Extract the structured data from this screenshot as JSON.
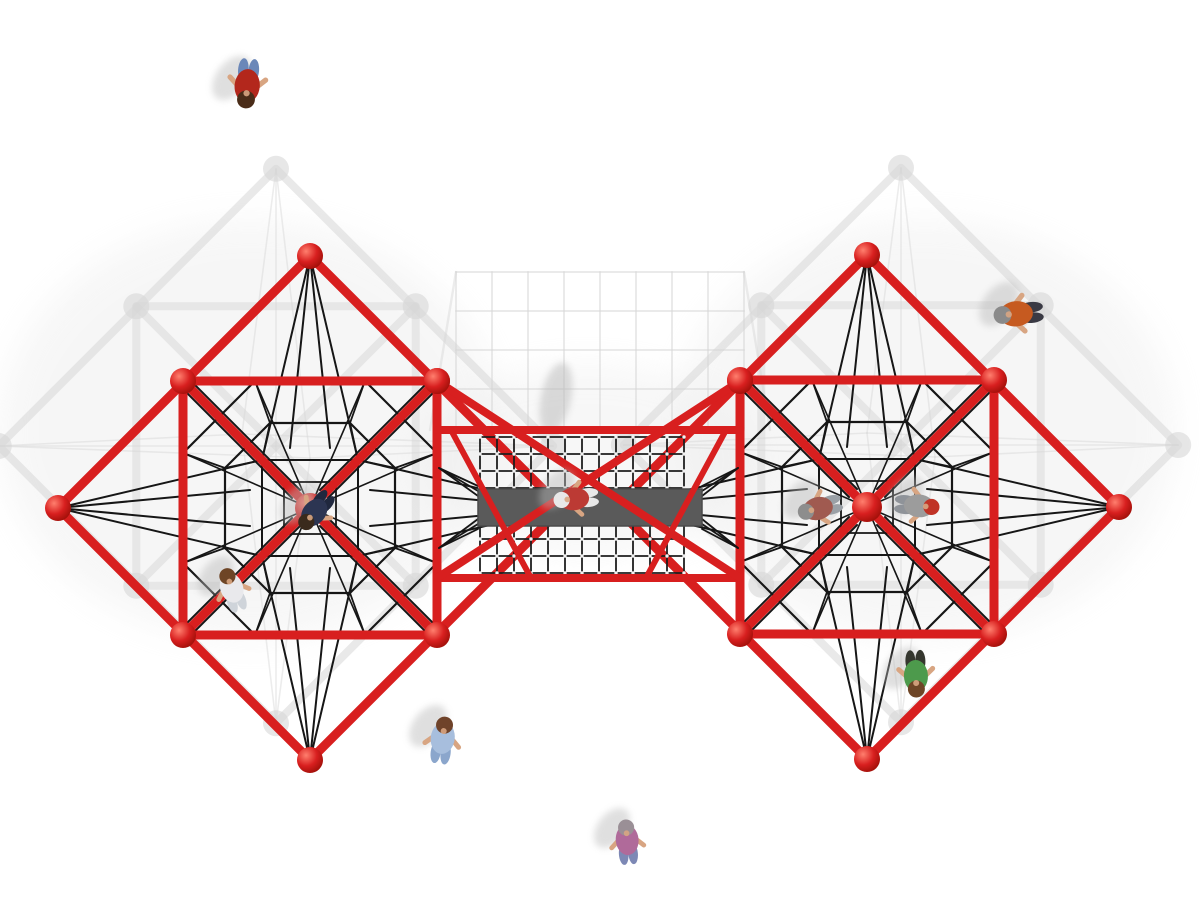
{
  "scene": {
    "width": 1200,
    "height": 900,
    "background": "#ffffff",
    "description": "Top-down 3D render of a red double-pyramid rope climbing playground structure joined by a central net bridge with a gray walkway plank; ten children play on and around it"
  },
  "palette": {
    "frame_red": "#d81f1f",
    "frame_red_dark": "#9e0f08",
    "sphere_highlight": "#ff7f6e",
    "rope_black": "#161616",
    "ghost_gray": "#d7d7d7",
    "ghost_gray_soft": "#e4e4e4",
    "walkway_gray": "#5a5a5a",
    "walkway_edge": "#4a4a4a",
    "grid_rope": "#1e1e1e",
    "grid_node": "#f2f2f2",
    "skin": "#d8a582",
    "shadow_soft": "#b9b9b9"
  },
  "structure": {
    "half_diagonal": 252,
    "half_square": 127,
    "ghost_scale": 1.1,
    "pyramids": [
      {
        "id": "left",
        "cx": 310,
        "cy": 508,
        "ghost_dx": -34,
        "ghost_dy": -62
      },
      {
        "id": "right",
        "cx": 867,
        "cy": 507,
        "ghost_dx": 34,
        "ghost_dy": -62
      }
    ],
    "bridge": {
      "x_left": 437,
      "x_right": 740,
      "rail_top": 430,
      "rail_bottom": 578,
      "mid_sphere_top_y": 381,
      "mid_sphere_bottom_y": 635,
      "grid_x": 480,
      "grid_y": 437,
      "cell": 17,
      "cols": 12,
      "rows": 8,
      "plank": {
        "x": 478,
        "y": 489,
        "w": 224,
        "h": 37
      },
      "braces": [
        [
          451,
          430,
          531,
          578
        ],
        [
          726,
          430,
          646,
          578
        ]
      ],
      "ghost_grid": {
        "x1": 456,
        "x2": 744,
        "y1": 272,
        "y2": 430,
        "step_x": 36,
        "step_y": 39
      }
    }
  },
  "children": [
    {
      "id": 1,
      "x": 247,
      "y": 88,
      "rot": 185,
      "scale": 1.05,
      "shirt": "#b3271c",
      "pants": "#6b87b8",
      "hair": "#4a2c18"
    },
    {
      "id": 2,
      "x": 1014,
      "y": 314,
      "rot": 265,
      "scale": 1.05,
      "shirt": "#c65a20",
      "pants": "#3a3a44",
      "hair": "#8a8a8a"
    },
    {
      "id": 3,
      "x": 313,
      "y": 514,
      "rot": 220,
      "scale": 0.95,
      "shirt": "#2c3552",
      "pants": "#20283e",
      "hair": "#3a2a1c"
    },
    {
      "id": 4,
      "x": 231,
      "y": 586,
      "rot": 340,
      "scale": 0.95,
      "shirt": "#e9e9ec",
      "pants": "#cfd4da",
      "hair": "#6e4526"
    },
    {
      "id": 5,
      "x": 572,
      "y": 499,
      "rot": 265,
      "scale": 0.95,
      "shirt": "#bc3a34",
      "pants": "#e8e8e8",
      "hair": "#e8e8e8"
    },
    {
      "id": 6,
      "x": 443,
      "y": 736,
      "rot": 8,
      "scale": 1.0,
      "shirt": "#a7bedd",
      "pants": "#8ba6cc",
      "hair": "#6f432a"
    },
    {
      "id": 7,
      "x": 627,
      "y": 838,
      "rot": 355,
      "scale": 0.95,
      "shirt": "#b06a9a",
      "pants": "#7d88b5",
      "hair": "#9a8f96"
    },
    {
      "id": 8,
      "x": 916,
      "y": 678,
      "rot": 178,
      "scale": 1.0,
      "shirt": "#4d9a4c",
      "pants": "#35372f",
      "hair": "#6e4526"
    },
    {
      "id": 9,
      "x": 816,
      "y": 509,
      "rot": 255,
      "scale": 0.95,
      "shirt": "#a05a50",
      "pants": "#9aa0a6",
      "hair": "#8d8d8d"
    },
    {
      "id": 10,
      "x": 921,
      "y": 506,
      "rot": 95,
      "scale": 0.95,
      "shirt": "#9c9c9c",
      "pants": "#8f9399",
      "hair": "#c03326"
    }
  ]
}
